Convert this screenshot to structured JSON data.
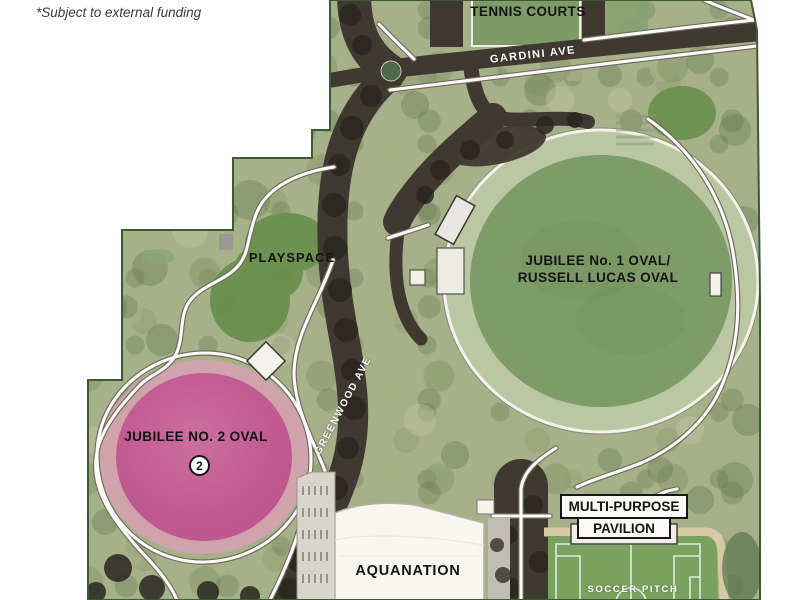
{
  "note": "*Subject to external funding",
  "map": {
    "areas": {
      "tennis_courts": "TENNIS COURTS",
      "playspace": "PLAYSPACE",
      "oval1_line1": "JUBILEE No. 1 OVAL/",
      "oval1_line2": "RUSSELL LUCAS OVAL",
      "oval2": "JUBILEE NO. 2 OVAL",
      "oval2_marker": "2",
      "aquanation": "AQUANATION",
      "pavilion_line1": "MULTI-PURPOSE",
      "pavilion_line2": "PAVILION",
      "soccer_pitch": "SOCCER PITCH"
    },
    "streets": {
      "gardini": "GARDINI AVE",
      "greenwood": "GREENWOOD AVE"
    },
    "colors": {
      "map_base_green": "#a6b089",
      "dark_planting_green": "#69904f",
      "oval1_field_green": "#7e9c67",
      "oval2_pink": "#c25d92",
      "road_dark": "#3f3932",
      "path_white": "#fcfbf7",
      "soccer_pitch_green": "#7aa25e",
      "border_green": "#3e5a34"
    }
  }
}
